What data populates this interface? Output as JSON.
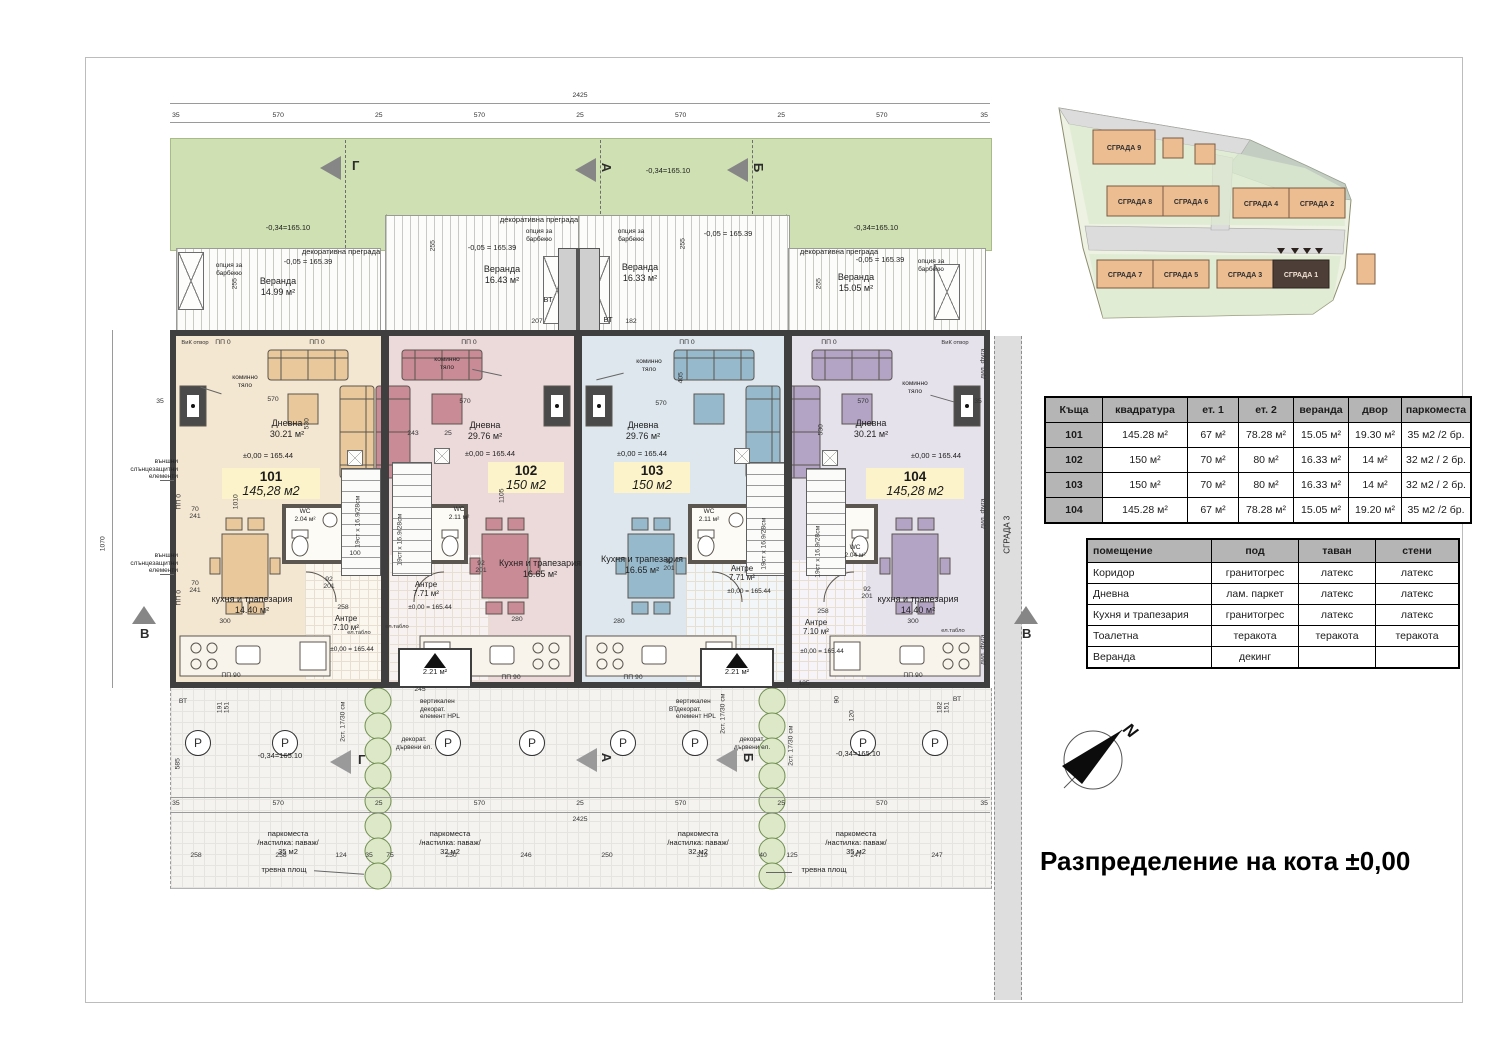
{
  "sheet": {
    "title": "Разпределение на кота ±0,00"
  },
  "markers": {
    "g": "Г",
    "a": "А",
    "b": "Б",
    "v": "В",
    "n": "N"
  },
  "dims": {
    "total": "2425",
    "seg": [
      "35",
      "570",
      "25",
      "570",
      "25",
      "570",
      "25",
      "570",
      "35"
    ],
    "sub": [
      "258",
      "258",
      "124",
      "35",
      "75",
      "250",
      "246",
      "250",
      "319",
      "40",
      "125",
      "247",
      "247"
    ],
    "tiny": [
      "255",
      "255",
      "255",
      "255",
      "207",
      "182",
      "570",
      "570",
      "570",
      "570",
      "530",
      "530",
      "405",
      "243",
      "25",
      "280",
      "280",
      "300",
      "300",
      "1010",
      "1105",
      "100",
      "35",
      "35",
      "1070",
      "125",
      "245",
      "90",
      "120",
      "258",
      "258",
      "70\n241",
      "70\n241",
      "585",
      "191\n151",
      "182\n151"
    ]
  },
  "units": [
    {
      "num": "101",
      "area": "145,28 м2",
      "living": "Дневна\n30.21 м²",
      "kitchen": "кухня и трапезария\n14.40 м²",
      "entry": "Антре\n7.10 м²",
      "wc": "WC\n2.04 м²",
      "veranda": "Веранда\n14.99 м²",
      "elev": "±0,00 = 165.44"
    },
    {
      "num": "102",
      "area": "150 м2",
      "living": "Дневна\n29.76 м²",
      "kitchen": "Кухня и трапезария\n16.65 м²",
      "entry": "Антре\n7.71 м²",
      "wc": "WC\n2.11 м²",
      "veranda": "Веранда\n16.43 м²",
      "elev": "±0,00 = 165.44",
      "porch": "2.21 м²"
    },
    {
      "num": "103",
      "area": "150 м2",
      "living": "Дневна\n29.76 м²",
      "kitchen": "Кухня и трапезария\n16.65 м²",
      "entry": "Антре\n7.71 м²",
      "wc": "WC\n2.11 м²",
      "veranda": "Веранда\n16.33 м²",
      "elev": "±0,00 = 165.44",
      "porch": "2.21 м²"
    },
    {
      "num": "104",
      "area": "145,28 м2",
      "living": "Дневна\n30.21 м²",
      "kitchen": "кухня и трапезария\n14.40 м²",
      "entry": "Антре\n7.10 м²",
      "wc": "WC\n2.04 м²",
      "veranda": "Веранда\n15.05 м²",
      "elev": "±0,00 = 165.44"
    }
  ],
  "ann": {
    "lawn_elev": "-0,34=165.10",
    "ver_elev": "-0,05 = 165.39",
    "partition": "декоративна преграда",
    "bbq": "опция за\nбарбекю",
    "chimney": "коминно\nтяло",
    "sun": "външни\nслънцезащитни\nелементи",
    "vt": "ВТ",
    "pp0": "ПП 0",
    "pp90": "ПП 90",
    "vik": "ВиК отвор",
    "stairs": "19ст x 16.9/28см",
    "steps2": "2ст. 17/30 см",
    "hpl": "вертикален\nдекорат.\nелемент HPL",
    "wood": "декорат.\nдървени ел.",
    "board": "ел.табло",
    "park35": "паркоместа\n/настилка: паваж/\n35 м2",
    "park32": "паркоместа\n/настилка: паваж/\n32 м2",
    "grass": "тревна площ",
    "p": "P",
    "bld3": "СГРАДА 3",
    "joint": "дил. фуга",
    "door": "92\n201"
  },
  "site": {
    "b9": "СГРАДА 9",
    "b8": "СГРАДА 8",
    "b6": "СГРАДА 6",
    "b4": "СГРАДА 4",
    "b2": "СГРАДА 2",
    "b7": "СГРАДА 7",
    "b5": "СГРАДА 5",
    "b3": "СГРАДА 3",
    "b1": "СГРАДА 1"
  },
  "tables": {
    "areas": {
      "headers": [
        "Къща",
        "квадратура",
        "ет. 1",
        "ет. 2",
        "веранда",
        "двор",
        "паркоместа"
      ],
      "rows": [
        [
          "101",
          "145.28 м²",
          "67 м²",
          "78.28 м²",
          "15.05 м²",
          "19.30 м²",
          "35 м2 /2 бр."
        ],
        [
          "102",
          "150 м²",
          "70 м²",
          "80 м²",
          "16.33 м²",
          "14 м²",
          "32 м2 / 2 бр."
        ],
        [
          "103",
          "150 м²",
          "70 м²",
          "80 м²",
          "16.33 м²",
          "14 м²",
          "32 м2 / 2 бр."
        ],
        [
          "104",
          "145.28 м²",
          "67 м²",
          "78.28 м²",
          "15.05 м²",
          "19.20 м²",
          "35 м2 /2 бр."
        ]
      ]
    },
    "finishes": {
      "headers": [
        "помещение",
        "под",
        "таван",
        "стени"
      ],
      "rows": [
        [
          "Коридор",
          "гранитогрес",
          "латекс",
          "латекс"
        ],
        [
          "Дневна",
          "лам. паркет",
          "латекс",
          "латекс"
        ],
        [
          "Кухня и трапезария",
          "гранитогрес",
          "латекс",
          "латекс"
        ],
        [
          "Тоалетна",
          "теракота",
          "теракота",
          "теракота"
        ],
        [
          "Веранда",
          "декинг",
          "",
          ""
        ]
      ]
    }
  }
}
